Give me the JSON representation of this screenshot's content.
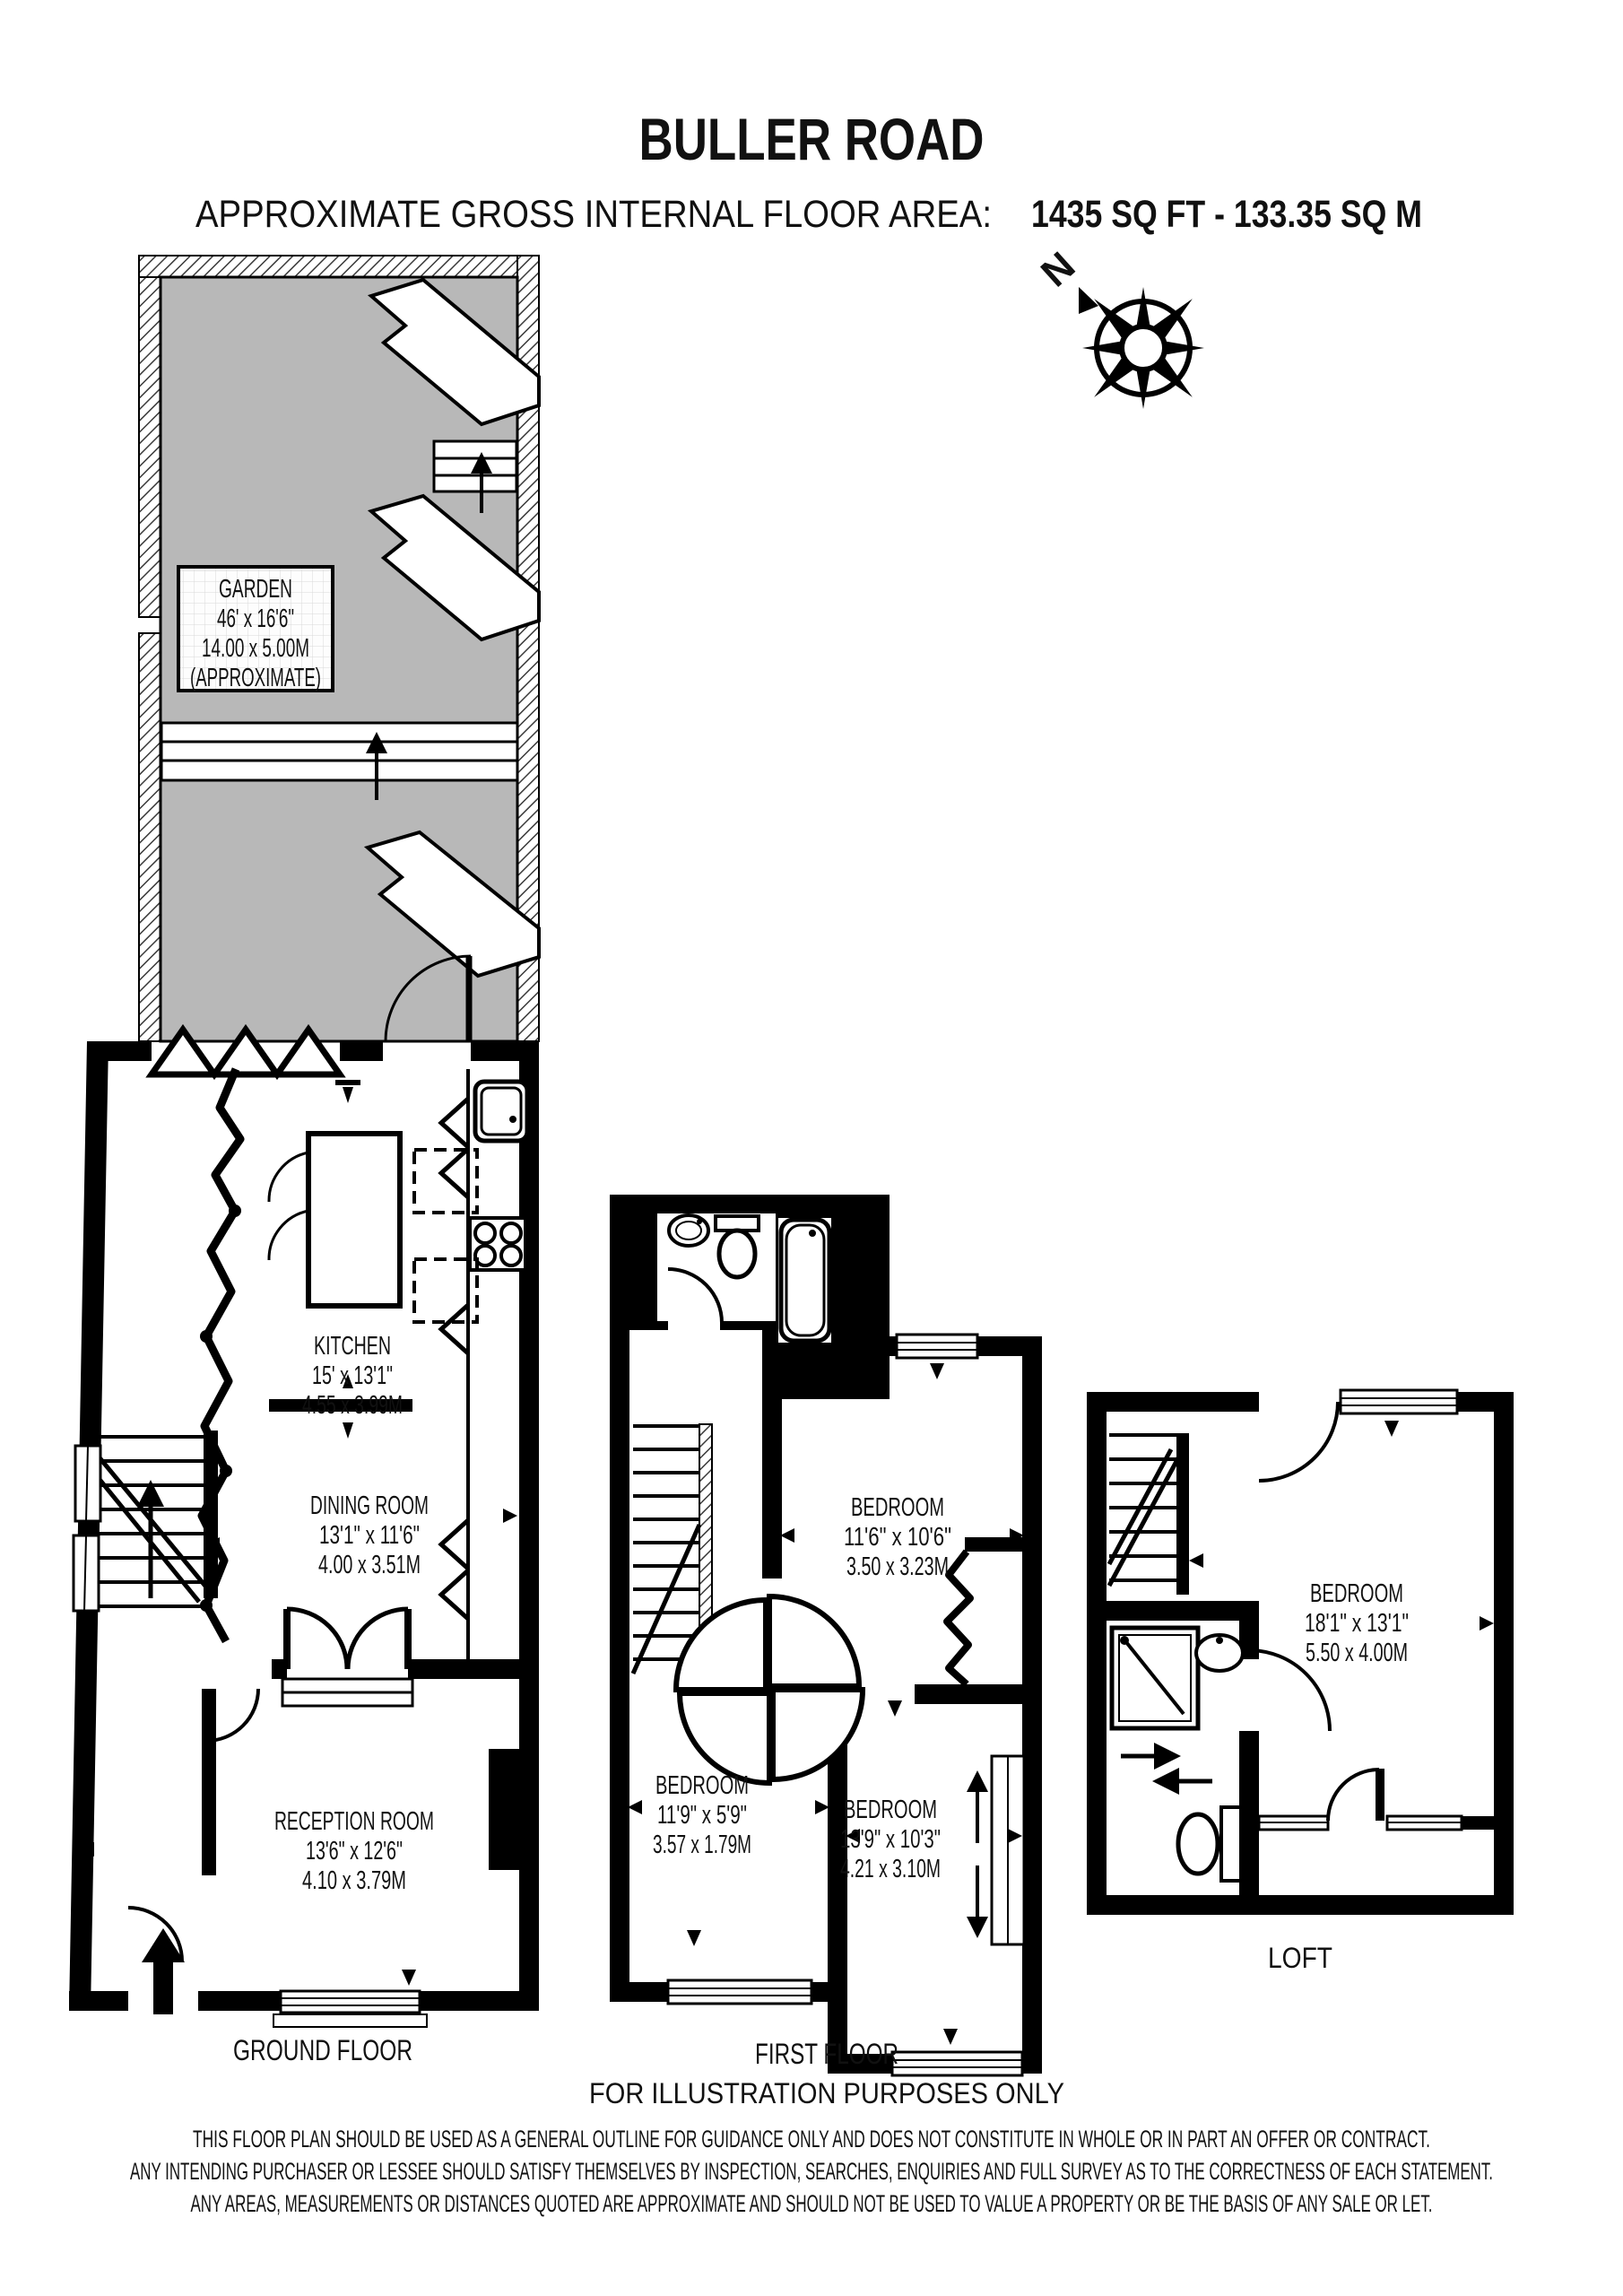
{
  "header": {
    "title": "BULLER ROAD",
    "area_label": "APPROXIMATE GROSS INTERNAL FLOOR AREA:",
    "area_value": "1435 SQ FT  -  133.35 SQ M"
  },
  "compass": {
    "north_label": "N"
  },
  "garden": {
    "name": "GARDEN",
    "imperial": "46' x 16'6\"",
    "metric": "14.00 x 5.00M",
    "note": "(APPROXIMATE)"
  },
  "ground_floor": {
    "label": "GROUND FLOOR",
    "kitchen": {
      "name": "KITCHEN",
      "imperial": "15' x 13'1\"",
      "metric": "4.55 x 3.99M"
    },
    "dining_room": {
      "name": "DINING ROOM",
      "imperial": "13'1\" x 11'6\"",
      "metric": "4.00 x 3.51M"
    },
    "reception_room": {
      "name": "RECEPTION ROOM",
      "imperial": "13'6\" x 12'6\"",
      "metric": "4.10 x 3.79M"
    }
  },
  "first_floor": {
    "label": "FIRST FLOOR",
    "note": "FOR ILLUSTRATION PURPOSES ONLY",
    "bedroom_top": {
      "name": "BEDROOM",
      "imperial": "11'6\" x 10'6\"",
      "metric": "3.50 x 3.23M"
    },
    "bedroom_left": {
      "name": "BEDROOM",
      "imperial": "11'9\" x 5'9\"",
      "metric": "3.57 x 1.79M"
    },
    "bedroom_right": {
      "name": "BEDROOM",
      "imperial": "13'9\" x 10'3\"",
      "metric": "4.21 x 3.10M"
    }
  },
  "loft": {
    "label": "LOFT",
    "bedroom": {
      "name": "BEDROOM",
      "imperial": "18'1\" x 13'1\"",
      "metric": "5.50 x 4.00M"
    }
  },
  "disclaimer": {
    "line1": "THIS FLOOR PLAN SHOULD BE USED AS A GENERAL OUTLINE FOR GUIDANCE ONLY AND DOES NOT CONSTITUTE IN WHOLE OR IN PART AN OFFER OR CONTRACT.",
    "line2": "ANY INTENDING PURCHASER OR LESSEE SHOULD SATISFY THEMSELVES BY INSPECTION, SEARCHES, ENQUIRIES AND FULL SURVEY AS TO THE CORRECTNESS OF EACH STATEMENT.",
    "line3": "ANY AREAS, MEASUREMENTS OR DISTANCES QUOTED ARE APPROXIMATE AND SHOULD NOT BE USED TO VALUE A PROPERTY OR BE THE BASIS OF ANY SALE OR LET."
  },
  "colors": {
    "wall": "#000000",
    "garden_fill": "#b8b8b8",
    "background": "#ffffff"
  }
}
